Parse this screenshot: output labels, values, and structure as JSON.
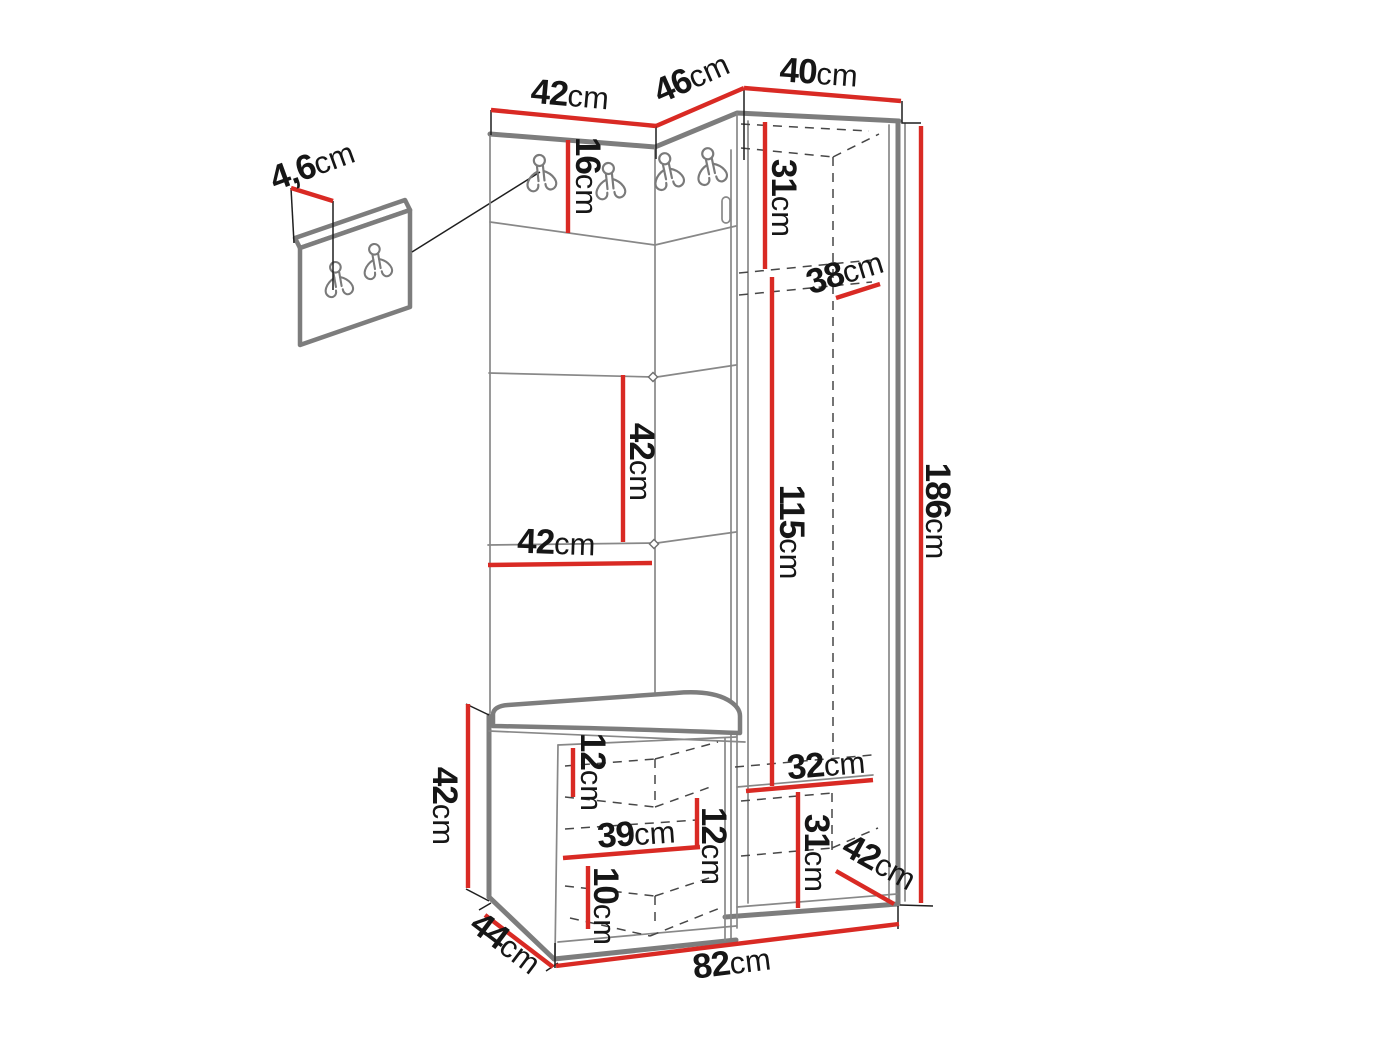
{
  "diagram": {
    "kind": "hallway-furniture-dimension-drawing",
    "unit": "cm"
  },
  "colors": {
    "dimension_line": "#d92a24",
    "structure_outline": "#7d7d7d",
    "label_text": "#161616",
    "background": "#ffffff"
  },
  "dimensions": {
    "top_panel_width": {
      "value": "42",
      "unit": "cm"
    },
    "corner_top_width": {
      "value": "46",
      "unit": "cm"
    },
    "cabinet_top_width": {
      "value": "40",
      "unit": "cm"
    },
    "hook_strip_height": {
      "value": "16",
      "unit": "cm"
    },
    "cabinet_upper_space": {
      "value": "31",
      "unit": "cm"
    },
    "shelf_depth": {
      "value": "38",
      "unit": "cm"
    },
    "hanging_space_height": {
      "value": "115",
      "unit": "cm"
    },
    "panel_height": {
      "value": "42",
      "unit": "cm"
    },
    "panel_width": {
      "value": "42",
      "unit": "cm"
    },
    "total_height": {
      "value": "186",
      "unit": "cm"
    },
    "bench_height": {
      "value": "42",
      "unit": "cm"
    },
    "bench_top_inset": {
      "value": "12",
      "unit": "cm"
    },
    "bench_inner_width": {
      "value": "39",
      "unit": "cm"
    },
    "bench_shelf_spacing": {
      "value": "12",
      "unit": "cm"
    },
    "bench_bottom_inset": {
      "value": "10",
      "unit": "cm"
    },
    "cabinet_bottom_width": {
      "value": "32",
      "unit": "cm"
    },
    "cabinet_bottom_height": {
      "value": "31",
      "unit": "cm"
    },
    "cabinet_bottom_depth": {
      "value": "42",
      "unit": "cm"
    },
    "bench_depth": {
      "value": "44",
      "unit": "cm"
    },
    "bottom_total_width": {
      "value": "82",
      "unit": "cm"
    },
    "hook_panel_thickness": {
      "value": "4,6",
      "unit": "cm"
    }
  }
}
